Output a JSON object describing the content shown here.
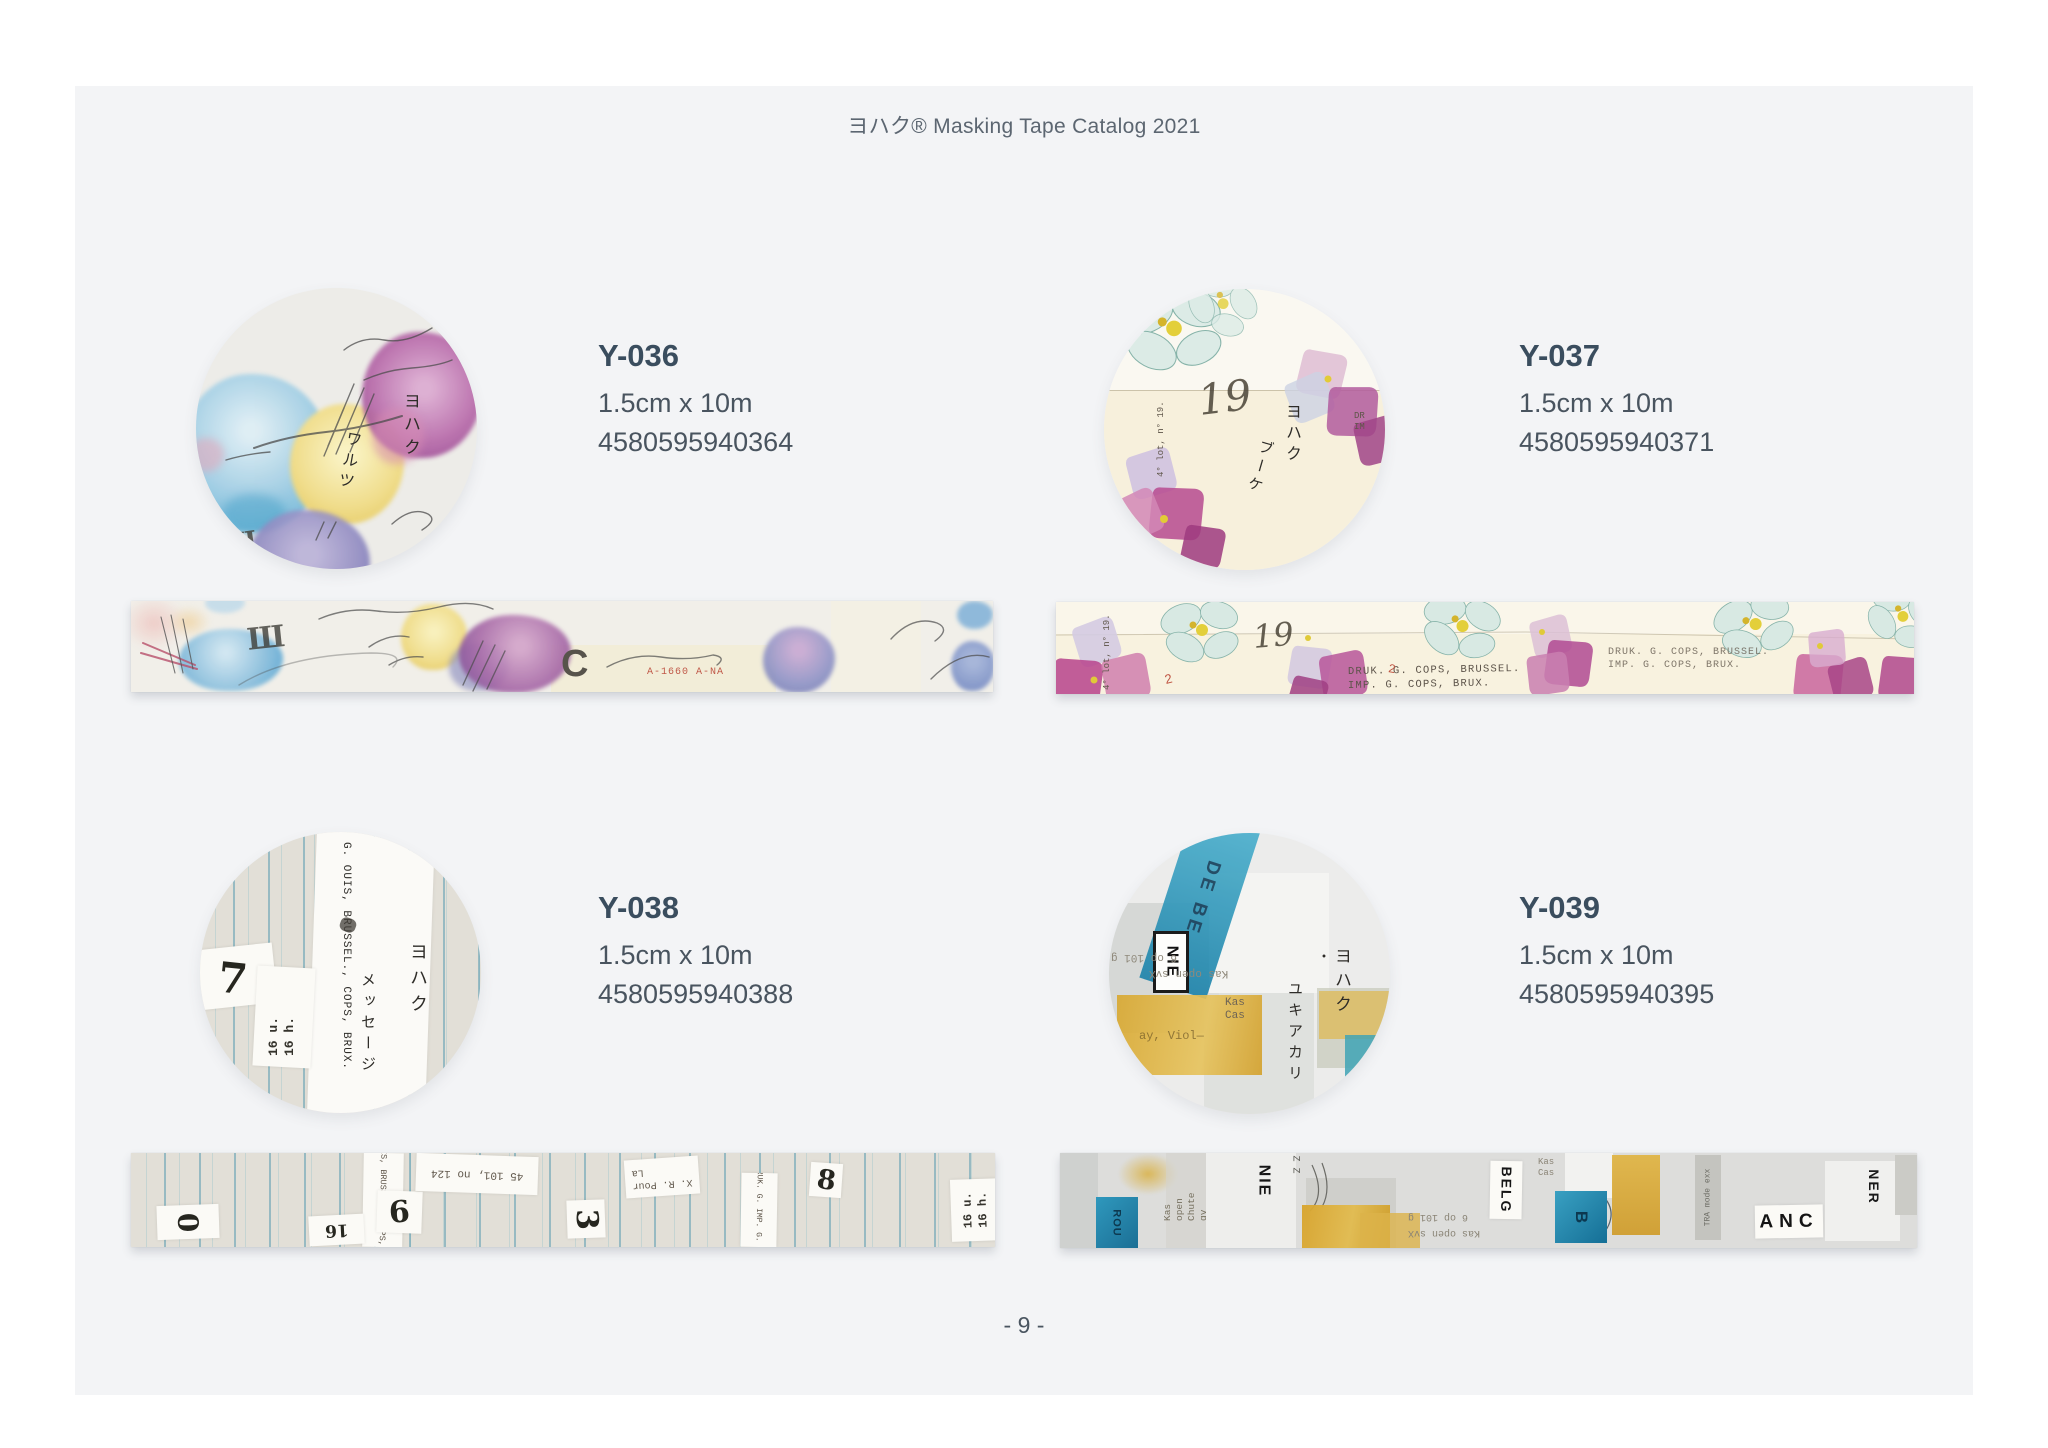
{
  "page": {
    "header": "ヨハク® Masking Tape Catalog 2021",
    "page_number": "- 9 -",
    "panel_color": "#f3f4f6",
    "title_color": "#3a4d5e",
    "text_color": "#49545f"
  },
  "products": [
    {
      "code": "Y-036",
      "size": "1.5cm x 10m",
      "barcode": "4580595940364",
      "design": {
        "brand": "ヨハク",
        "name": "ワルツ",
        "stamp": "Ш",
        "letter": "C",
        "plate": "A-1660 A-NA"
      }
    },
    {
      "code": "Y-037",
      "size": "1.5cm x 10m",
      "barcode": "4580595940371",
      "design": {
        "brand": "ヨハク",
        "name": "ブーケ",
        "stamp": "19",
        "print1": "DRUK. G. COPS, BRUSSEL.",
        "print2": "IMP. G. COPS, BRUX.",
        "lot": "4° lot, n° 19.",
        "edge": "DR\nIM",
        "mark": "2"
      }
    },
    {
      "code": "Y-038",
      "size": "1.5cm x 10m",
      "barcode": "4580595940388",
      "design": {
        "brand": "ヨハク",
        "name": "メッセージ",
        "printer": "G. OUIS, BRUSSEL., COPS, BRUX.",
        "hours": "16 u.\n16 h.",
        "ref": "45 101, no 124",
        "pour": "X. R. Pour\nLa",
        "druk": "DRUK. G. IMP. G. CO",
        "d7": "7",
        "d0": "0",
        "d16": "16",
        "d6": "6",
        "d3": "3",
        "d8": "8"
      }
    },
    {
      "code": "Y-039",
      "size": "1.5cm x 10m",
      "barcode": "4580595940395",
      "design": {
        "brand": "ヨハク",
        "name": "ユキアカリ",
        "dot": "・",
        "nie": "NIE",
        "debe": "DE BE",
        "belg": "BELG",
        "anc": "ANC",
        "ner": "NER",
        "b": "B",
        "rou": "ROU",
        "kas": "Kas\nCas",
        "zz": "Z Z",
        "open": "Kas open\nChute qv",
        "type1": "6 op 101 g",
        "type2": "Kas open svX",
        "viol": "ay, Viol—"
      }
    }
  ]
}
